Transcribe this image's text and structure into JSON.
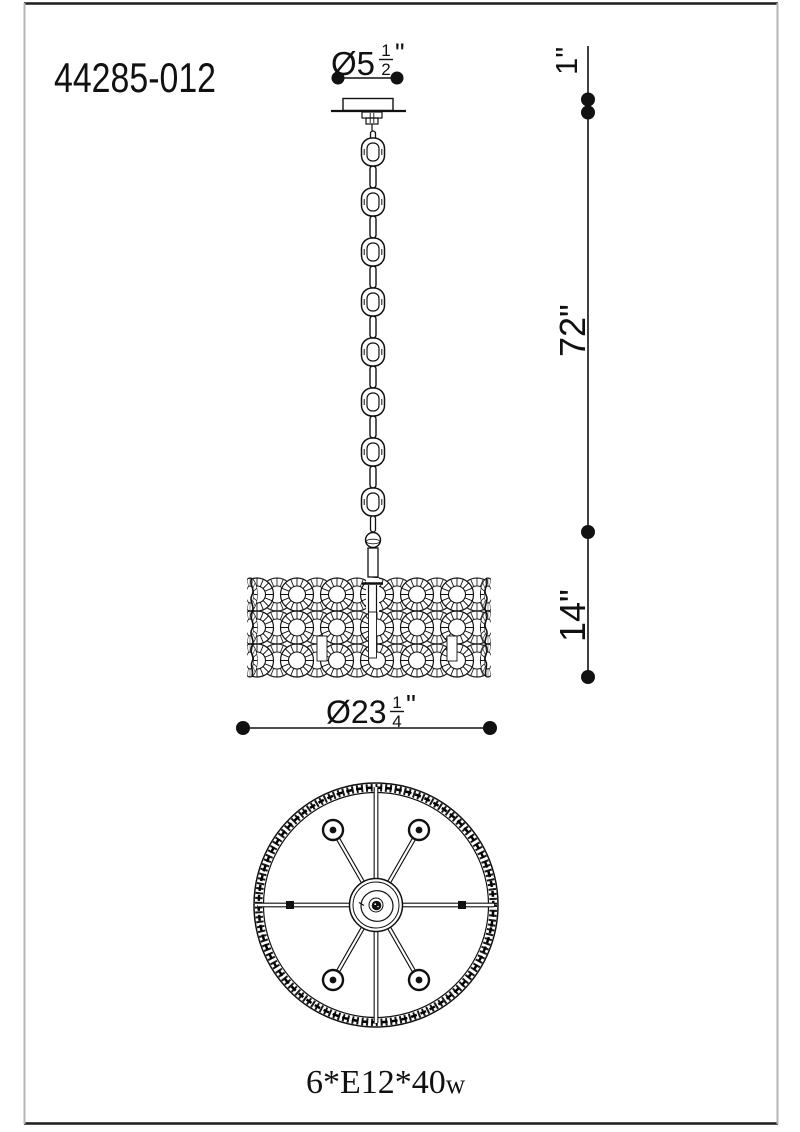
{
  "title": {
    "model_number": "44285-012"
  },
  "dimensions": {
    "canopy_diameter": {
      "prefix": "Ø5",
      "numerator": "1",
      "denominator": "2",
      "unit": "\""
    },
    "drum_diameter": {
      "prefix": "Ø23",
      "numerator": "1",
      "denominator": "4",
      "unit": "\""
    },
    "canopy_height": "1\"",
    "chain_length": "72\"",
    "drum_height": "14\""
  },
  "lamp_spec": {
    "count_and_base": "6*E12*40",
    "wattage_suffix": "w"
  },
  "colors": {
    "ink": "#111111",
    "background": "#ffffff",
    "frame_top_bottom": "#1c1c1c",
    "frame_sides": "#b5b5b5"
  }
}
